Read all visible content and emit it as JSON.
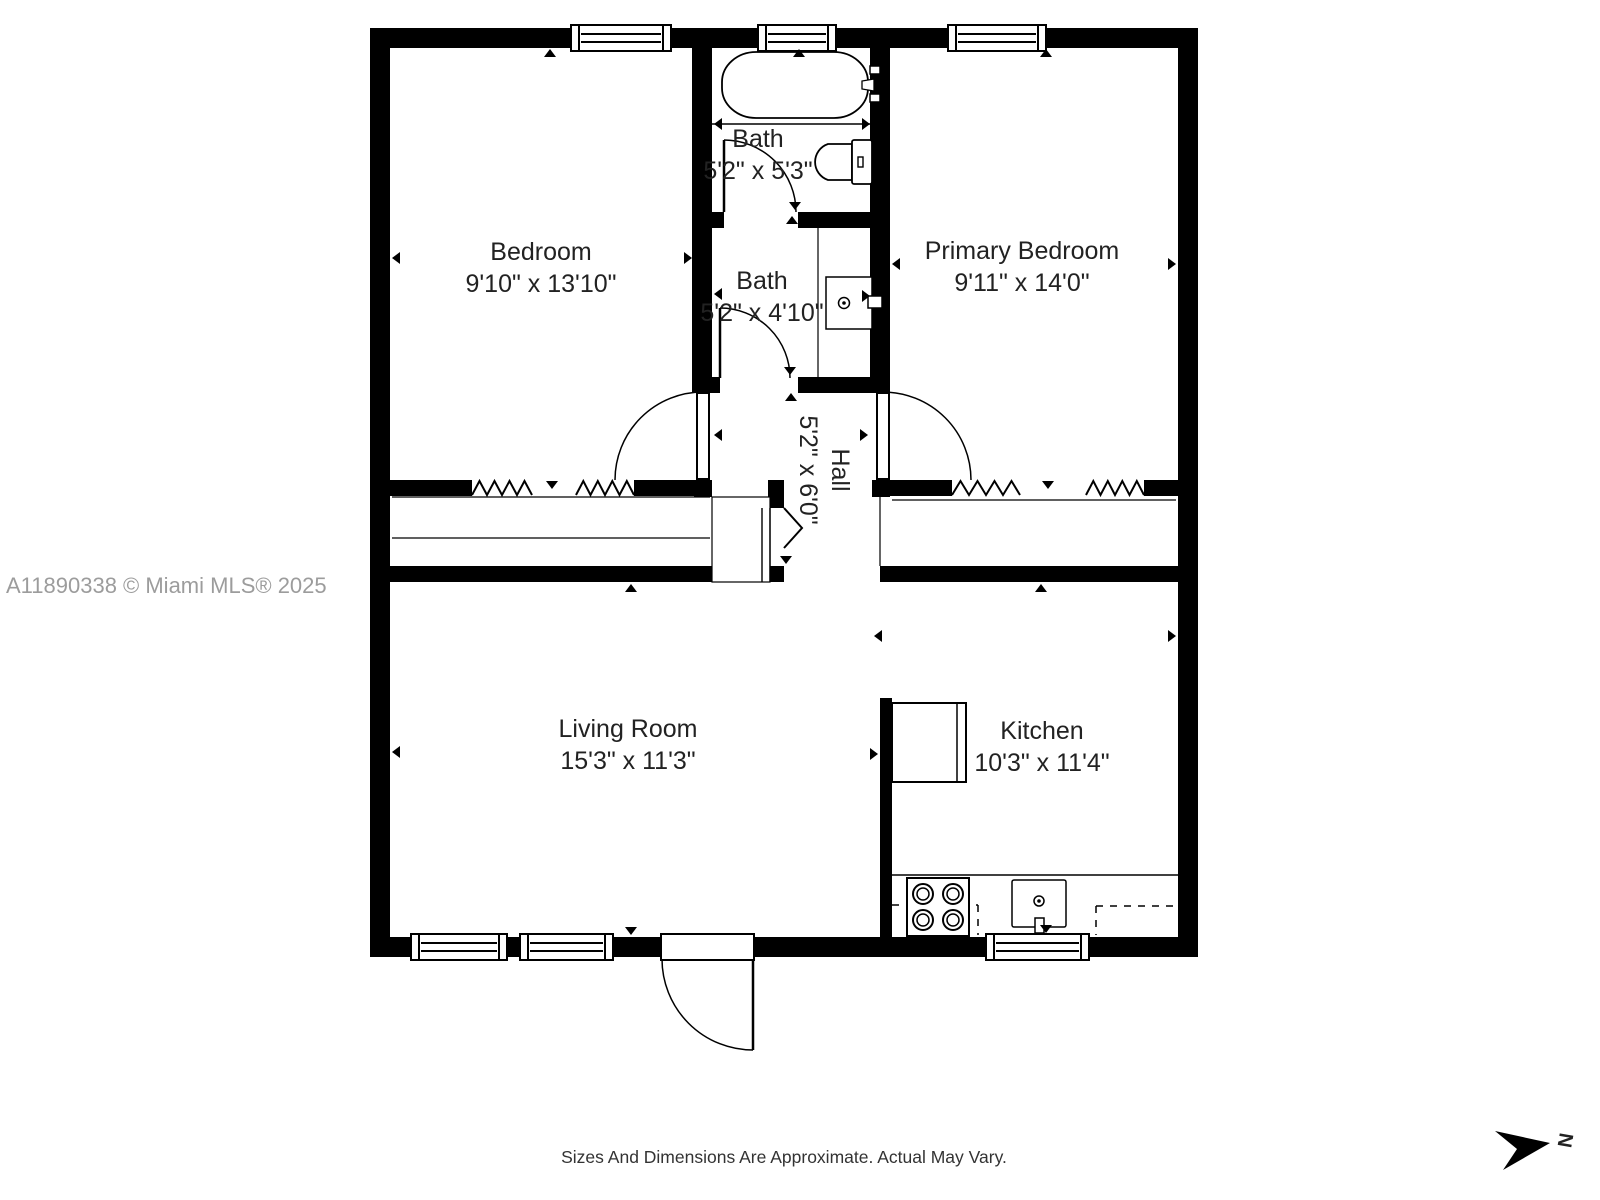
{
  "page": {
    "watermark": "A11890338 © Miami MLS® 2025",
    "disclaimer": "Sizes And Dimensions Are Approximate. Actual May Vary.",
    "compass_label": "N"
  },
  "rooms": {
    "bedroom": {
      "name": "Bedroom",
      "dims": "9'10\" x 13'10\""
    },
    "bath_top": {
      "name": "Bath",
      "dims": "5'2\" x 5'3\""
    },
    "bath_mid": {
      "name": "Bath",
      "dims": "5'2\" x 4'10\""
    },
    "primary_bedroom": {
      "name": "Primary Bedroom",
      "dims": "9'11\" x 14'0\""
    },
    "hall": {
      "name": "Hall",
      "dims": "5'2\" x 6'0\""
    },
    "living_room": {
      "name": "Living Room",
      "dims": "15'3\" x 11'3\""
    },
    "kitchen": {
      "name": "Kitchen",
      "dims": "10'3\" x 11'4\""
    }
  },
  "fixtures": [
    "bathtub",
    "toilet",
    "vanity-sink",
    "refrigerator",
    "stove",
    "kitchen-sink",
    "closet-bifold-doors",
    "entry-door"
  ],
  "colors": {
    "wall": "#000000",
    "label_text": "#222222",
    "watermark_text": "#9c9c9c",
    "disclaimer_text": "#333333"
  }
}
